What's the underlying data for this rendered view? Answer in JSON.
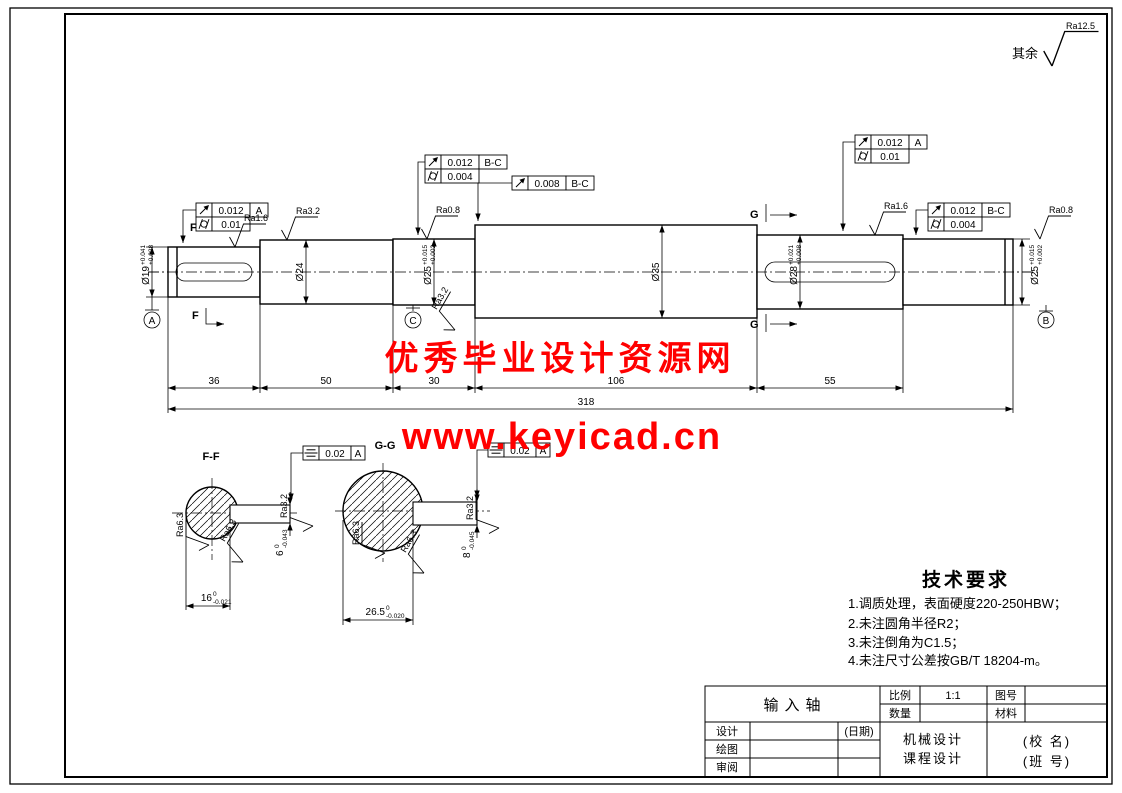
{
  "colors": {
    "line": "#000000",
    "background": "#ffffff",
    "watermark": "#ff0000"
  },
  "general_roughness": {
    "prefix": "其余",
    "value": "Ra12.5"
  },
  "watermark": {
    "line1": "优秀毕业设计资源网",
    "line2": "www.keyicad.cn"
  },
  "main_view": {
    "diameters": {
      "d1": {
        "text": "Ø19",
        "sup": "+0.041",
        "sub": "+0.028"
      },
      "d2": {
        "text": "Ø24"
      },
      "d3": {
        "text": "Ø25",
        "sup": "+0.015",
        "sub": "+0.002"
      },
      "d4": {
        "text": "Ø35"
      },
      "d5": {
        "text": "Ø28",
        "sup": "+0.021",
        "sub": "+0.008"
      },
      "d6": {
        "text": "Ø25",
        "sup": "+0.015",
        "sub": "+0.002"
      }
    },
    "lengths": {
      "l1": "36",
      "l2": "50",
      "l3": "30",
      "l4": "106",
      "l5": "55",
      "total": "318"
    },
    "rough": {
      "r1": "Ra1.6",
      "r2": "Ra3.2",
      "r3": "Ra0.8",
      "r4": "Ra1.6",
      "r5": "Ra0.8"
    },
    "tol": {
      "tf1": {
        "val1": "0.012",
        "dat1": "A",
        "val2": "0.01"
      },
      "tf2": {
        "val1": "0.012",
        "dat1": "B-C",
        "val2": "0.004"
      },
      "tf3": {
        "val": "0.008",
        "dat": "B-C"
      },
      "tf4": {
        "val1": "0.012",
        "dat1": "A",
        "val2": "0.01"
      },
      "tf5": {
        "val1": "0.012",
        "dat1": "B-C",
        "val2": "0.004"
      }
    },
    "marks": {
      "f": "F",
      "g": "G"
    },
    "datums": {
      "a": "A",
      "b": "B",
      "c": "C"
    }
  },
  "ff": {
    "title": "F-F",
    "tol": {
      "val": "0.02",
      "dat": "A"
    },
    "width": {
      "val": "6",
      "sup": "0",
      "sub": "-0.043"
    },
    "across": {
      "val": "16",
      "sup": "0",
      "sub": "-0.021"
    },
    "ra_side": "Ra3.2",
    "ra1": "Ra6.3",
    "ra2": "Ra6.3"
  },
  "gg": {
    "title": "G-G",
    "tol": {
      "val": "0.02",
      "dat": "A"
    },
    "width": {
      "val": "8",
      "sup": "0",
      "sub": "-0.045"
    },
    "across": {
      "val": "26.5",
      "sup": "0",
      "sub": "-0.020"
    },
    "ra_side": "Ra3.2",
    "ra1": "Ra6.3",
    "ra2": "Ra6.3"
  },
  "tech": {
    "title": "技术要求",
    "items": [
      "1.调质处理，表面硬度220-250HBW；",
      "2.未注圆角半径R2；",
      "3.未注倒角为C1.5；",
      "4.未注尺寸公差按GB/T 18204-m。"
    ]
  },
  "tb": {
    "part_name": "输入轴",
    "scale_label": "比例",
    "scale_value": "1:1",
    "qty_label": "数量",
    "qty_value": "",
    "dwgno_label": "图号",
    "dwgno_value": "",
    "material_label": "材料",
    "material_value": "",
    "design_label": "设计",
    "date_label": "(日期)",
    "draw_label": "绘图",
    "review_label": "审阅",
    "course1": "机械设计",
    "course2": "课程设计",
    "school1": "(校 名)",
    "school2": "(班 号)"
  }
}
